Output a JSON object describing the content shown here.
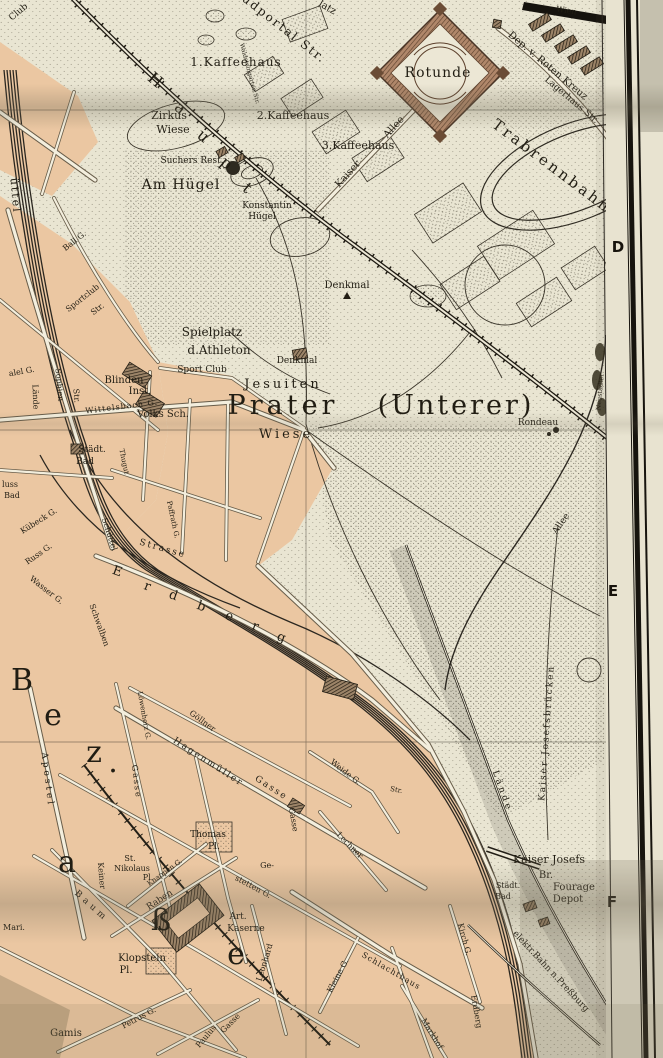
{
  "map": {
    "region_title": "Prater (Unterer)",
    "grid_letters": [
      {
        "t": "D",
        "x": 618,
        "y": 252
      },
      {
        "t": "E",
        "x": 613,
        "y": 596
      },
      {
        "t": "F",
        "x": 612,
        "y": 907
      }
    ],
    "labels": [
      {
        "t": "Club",
        "x": 20,
        "y": 14,
        "r": -40,
        "s": 9
      },
      {
        "t": "üttel",
        "x": 12,
        "y": 196,
        "r": 85,
        "s": 11,
        "sp": 2
      },
      {
        "t": "udportal Str.",
        "x": 282,
        "y": 32,
        "r": 38,
        "s": 12,
        "sp": 2
      },
      {
        "t": "latz",
        "x": 326,
        "y": 10,
        "r": 30,
        "s": 10
      },
      {
        "t": "1.Kaffeehaus",
        "x": 236,
        "y": 66,
        "s": 12,
        "sp": 1
      },
      {
        "t": "Waldsteingarten Str.",
        "x": 248,
        "y": 74,
        "r": 75,
        "s": 6
      },
      {
        "t": "Zirkus",
        "x": 169,
        "y": 119,
        "s": 11
      },
      {
        "t": "Wiese",
        "x": 173,
        "y": 133,
        "s": 11
      },
      {
        "t": "2.Kaffeehaus",
        "x": 293,
        "y": 119,
        "s": 11
      },
      {
        "t": "3.Kaffeehaus",
        "x": 358,
        "y": 149,
        "s": 11
      },
      {
        "t": "Kaiser",
        "x": 350,
        "y": 176,
        "r": -48,
        "s": 10
      },
      {
        "t": "Allee",
        "x": 396,
        "y": 129,
        "r": -48,
        "s": 10
      },
      {
        "t": "H",
        "x": 152,
        "y": 84,
        "r": 40,
        "s": 16
      },
      {
        "t": "a",
        "x": 177,
        "y": 112,
        "r": 40,
        "s": 16
      },
      {
        "t": "u",
        "x": 200,
        "y": 140,
        "r": 40,
        "s": 16
      },
      {
        "t": "p",
        "x": 223,
        "y": 167,
        "r": 40,
        "s": 16
      },
      {
        "t": "t",
        "x": 244,
        "y": 192,
        "r": 40,
        "s": 16
      },
      {
        "t": "Suchers Rest.",
        "x": 192,
        "y": 163,
        "s": 9
      },
      {
        "t": "Am Hügel",
        "x": 181,
        "y": 189,
        "s": 14,
        "sp": 1
      },
      {
        "t": "Konstantin",
        "x": 267,
        "y": 208,
        "s": 9
      },
      {
        "t": "Hügel",
        "x": 262,
        "y": 219,
        "s": 9
      },
      {
        "t": "Rotunde",
        "x": 438,
        "y": 77,
        "s": 14,
        "sp": 1
      },
      {
        "t": "Wien",
        "x": 566,
        "y": 13,
        "r": 9,
        "s": 8,
        "f": "#f2eddc"
      },
      {
        "t": "Dep. v. Roten Kreuz",
        "x": 546,
        "y": 68,
        "r": 40,
        "s": 10
      },
      {
        "t": "Lagerhaus Str.",
        "x": 570,
        "y": 102,
        "r": 40,
        "s": 9
      },
      {
        "t": "Trabrennbahn",
        "x": 549,
        "y": 170,
        "r": 37,
        "s": 15,
        "sp": 3
      },
      {
        "t": "Denkmal",
        "x": 347,
        "y": 288,
        "s": 10
      },
      {
        "t": "Ball G.",
        "x": 76,
        "y": 243,
        "r": -38,
        "s": 8
      },
      {
        "t": "Sportclub",
        "x": 84,
        "y": 300,
        "r": -38,
        "s": 8
      },
      {
        "t": "Str.",
        "x": 99,
        "y": 311,
        "r": -38,
        "s": 8
      },
      {
        "t": "Spielplatz",
        "x": 212,
        "y": 336,
        "s": 12
      },
      {
        "t": "d.Athleton",
        "x": 219,
        "y": 354,
        "s": 12
      },
      {
        "t": "Sport Club",
        "x": 202,
        "y": 372,
        "s": 9
      },
      {
        "t": "Denkmal",
        "x": 297,
        "y": 363,
        "s": 9
      },
      {
        "t": "Blinden",
        "x": 124,
        "y": 383,
        "s": 10
      },
      {
        "t": "Inst.",
        "x": 140,
        "y": 394,
        "s": 10
      },
      {
        "t": "Volks Sch.",
        "x": 163,
        "y": 417,
        "s": 10
      },
      {
        "t": "Wittelsbach G.",
        "x": 122,
        "y": 409,
        "r": -7,
        "s": 8,
        "sp": 1
      },
      {
        "t": "Jesuiten",
        "x": 283,
        "y": 388,
        "s": 13,
        "sp": 3
      },
      {
        "t": "Prater",
        "x": 283,
        "y": 414,
        "s": 27,
        "sp": 4
      },
      {
        "t": "(Unterer)",
        "x": 456,
        "y": 414,
        "s": 27,
        "sp": 3
      },
      {
        "t": "Wiese",
        "x": 286,
        "y": 438,
        "s": 13,
        "sp": 3
      },
      {
        "t": "Rondeau",
        "x": 538,
        "y": 425,
        "s": 9
      },
      {
        "t": "Sophien",
        "x": 57,
        "y": 385,
        "r": 85,
        "s": 8
      },
      {
        "t": "Str.",
        "x": 74,
        "y": 396,
        "r": 85,
        "s": 8
      },
      {
        "t": "alel G.",
        "x": 22,
        "y": 374,
        "r": -10,
        "s": 8
      },
      {
        "t": "Lände",
        "x": 33,
        "y": 397,
        "r": 88,
        "s": 8
      },
      {
        "t": "Städt.",
        "x": 92,
        "y": 452,
        "s": 9
      },
      {
        "t": "Bad",
        "x": 85,
        "y": 464,
        "s": 9
      },
      {
        "t": "luss",
        "x": 10,
        "y": 487,
        "s": 8
      },
      {
        "t": "Bad",
        "x": 12,
        "y": 498,
        "s": 8
      },
      {
        "t": "Thugut",
        "x": 122,
        "y": 462,
        "r": 78,
        "s": 7
      },
      {
        "t": "Schüttel",
        "x": 107,
        "y": 535,
        "r": 72,
        "s": 8
      },
      {
        "t": "Kübeck G.",
        "x": 40,
        "y": 523,
        "r": -32,
        "s": 8
      },
      {
        "t": "Russ G.",
        "x": 40,
        "y": 556,
        "r": -35,
        "s": 8
      },
      {
        "t": "Wasser G.",
        "x": 45,
        "y": 592,
        "r": 38,
        "s": 8
      },
      {
        "t": "Schwalben",
        "x": 97,
        "y": 626,
        "r": 70,
        "s": 8
      },
      {
        "t": "Strasse",
        "x": 162,
        "y": 551,
        "r": 16,
        "s": 9,
        "sp": 2
      },
      {
        "t": "Paffrath G.",
        "x": 171,
        "y": 520,
        "r": 78,
        "s": 7
      },
      {
        "t": "E",
        "x": 116,
        "y": 575,
        "r": 20,
        "s": 13
      },
      {
        "t": "r",
        "x": 146,
        "y": 590,
        "r": 20,
        "s": 13
      },
      {
        "t": "d",
        "x": 172,
        "y": 599,
        "r": 20,
        "s": 13
      },
      {
        "t": "b",
        "x": 200,
        "y": 610,
        "r": 20,
        "s": 13
      },
      {
        "t": "e",
        "x": 228,
        "y": 620,
        "r": 20,
        "s": 13
      },
      {
        "t": "r",
        "x": 254,
        "y": 630,
        "r": 20,
        "s": 13
      },
      {
        "t": "g",
        "x": 280,
        "y": 641,
        "r": 20,
        "s": 13
      },
      {
        "t": "Kaiser Josefsbrücken",
        "x": 549,
        "y": 733,
        "r": -86,
        "s": 9,
        "sp": 2
      },
      {
        "t": "Allee",
        "x": 563,
        "y": 525,
        "r": -55,
        "s": 9
      },
      {
        "t": "Neustädter",
        "x": 602,
        "y": 392,
        "r": -85,
        "s": 6.5
      },
      {
        "t": "Lände",
        "x": 500,
        "y": 792,
        "r": 70,
        "s": 9,
        "sp": 3
      },
      {
        "t": "B",
        "x": 22,
        "y": 690,
        "s": 30
      },
      {
        "t": "e",
        "x": 53,
        "y": 725,
        "s": 30
      },
      {
        "t": "z",
        "x": 94,
        "y": 762,
        "s": 30
      },
      {
        "t": ".",
        "x": 113,
        "y": 772,
        "s": 30
      },
      {
        "t": "a",
        "x": 67,
        "y": 872,
        "s": 30
      },
      {
        "t": "ß",
        "x": 161,
        "y": 930,
        "s": 30
      },
      {
        "t": "e",
        "x": 236,
        "y": 964,
        "s": 30
      },
      {
        "t": "Apostel",
        "x": 45,
        "y": 780,
        "r": 83,
        "s": 9,
        "sp": 3
      },
      {
        "t": "Gasse",
        "x": 134,
        "y": 782,
        "r": 83,
        "s": 8,
        "sp": 2
      },
      {
        "t": "Löwenherz G.",
        "x": 142,
        "y": 716,
        "r": 80,
        "s": 7
      },
      {
        "t": "Göllner",
        "x": 201,
        "y": 723,
        "r": 36,
        "s": 8
      },
      {
        "t": "Hagenmüller",
        "x": 207,
        "y": 764,
        "r": 33,
        "s": 9,
        "sp": 2
      },
      {
        "t": "Gasse",
        "x": 270,
        "y": 790,
        "r": 33,
        "s": 9,
        "sp": 2
      },
      {
        "t": "Gasse",
        "x": 291,
        "y": 820,
        "r": 80,
        "s": 8
      },
      {
        "t": "Weide G.",
        "x": 344,
        "y": 774,
        "r": 38,
        "s": 8
      },
      {
        "t": "Str.",
        "x": 396,
        "y": 792,
        "r": 10,
        "s": 7
      },
      {
        "t": "Lechner",
        "x": 348,
        "y": 847,
        "r": 45,
        "s": 8
      },
      {
        "t": "Thomas",
        "x": 208,
        "y": 837,
        "s": 9
      },
      {
        "t": "Pl.",
        "x": 214,
        "y": 849,
        "s": 9
      },
      {
        "t": "St.",
        "x": 130,
        "y": 861,
        "s": 8
      },
      {
        "t": "Nikolaus",
        "x": 132,
        "y": 871,
        "s": 8
      },
      {
        "t": "Pl.",
        "x": 148,
        "y": 880,
        "s": 8
      },
      {
        "t": "Knappen G.",
        "x": 166,
        "y": 874,
        "r": -36,
        "s": 7
      },
      {
        "t": "Raben",
        "x": 161,
        "y": 902,
        "r": -33,
        "s": 9
      },
      {
        "t": "Keiner",
        "x": 99,
        "y": 876,
        "r": 85,
        "s": 8
      },
      {
        "t": "Baum",
        "x": 90,
        "y": 908,
        "r": 42,
        "s": 9,
        "sp": 4
      },
      {
        "t": "Mari.",
        "x": 14,
        "y": 930,
        "s": 8
      },
      {
        "t": "Klopstein",
        "x": 142,
        "y": 961,
        "s": 10
      },
      {
        "t": "Pl.",
        "x": 126,
        "y": 973,
        "s": 10
      },
      {
        "t": "Art.",
        "x": 238,
        "y": 919,
        "s": 9
      },
      {
        "t": "Kaserne",
        "x": 246,
        "y": 931,
        "s": 9
      },
      {
        "t": "Ge-",
        "x": 267,
        "y": 868,
        "s": 8
      },
      {
        "t": "stetten G.",
        "x": 252,
        "y": 889,
        "r": 28,
        "s": 8
      },
      {
        "t": "Leonhard",
        "x": 267,
        "y": 963,
        "r": -73,
        "s": 8
      },
      {
        "t": "Kleine G.",
        "x": 340,
        "y": 977,
        "r": -62,
        "s": 8
      },
      {
        "t": "Schlachthaus",
        "x": 390,
        "y": 973,
        "r": 30,
        "s": 8,
        "sp": 1
      },
      {
        "t": "Markhof",
        "x": 430,
        "y": 1035,
        "r": 58,
        "s": 8
      },
      {
        "t": "Erdberg",
        "x": 474,
        "y": 1012,
        "r": 80,
        "s": 8
      },
      {
        "t": "Kirch G.",
        "x": 462,
        "y": 940,
        "r": 75,
        "s": 8
      },
      {
        "t": "Petrus G.",
        "x": 140,
        "y": 1020,
        "r": -28,
        "s": 8
      },
      {
        "t": "Paulus",
        "x": 208,
        "y": 1038,
        "r": -50,
        "s": 8
      },
      {
        "t": "Gasse",
        "x": 232,
        "y": 1025,
        "r": -45,
        "s": 8
      },
      {
        "t": "Gamis",
        "x": 66,
        "y": 1036,
        "s": 10
      },
      {
        "t": "Städt.",
        "x": 508,
        "y": 888,
        "s": 8
      },
      {
        "t": "Bad",
        "x": 503,
        "y": 899,
        "s": 8
      },
      {
        "t": "Kaiser Josefs",
        "x": 549,
        "y": 863,
        "s": 11
      },
      {
        "t": "Br.",
        "x": 546,
        "y": 878,
        "s": 10
      },
      {
        "t": "Fourage",
        "x": 574,
        "y": 890,
        "s": 10
      },
      {
        "t": "Depot",
        "x": 568,
        "y": 902,
        "s": 10
      },
      {
        "t": "elektr.Bahn n.Preßburg",
        "x": 549,
        "y": 973,
        "r": 47,
        "s": 9
      }
    ]
  }
}
